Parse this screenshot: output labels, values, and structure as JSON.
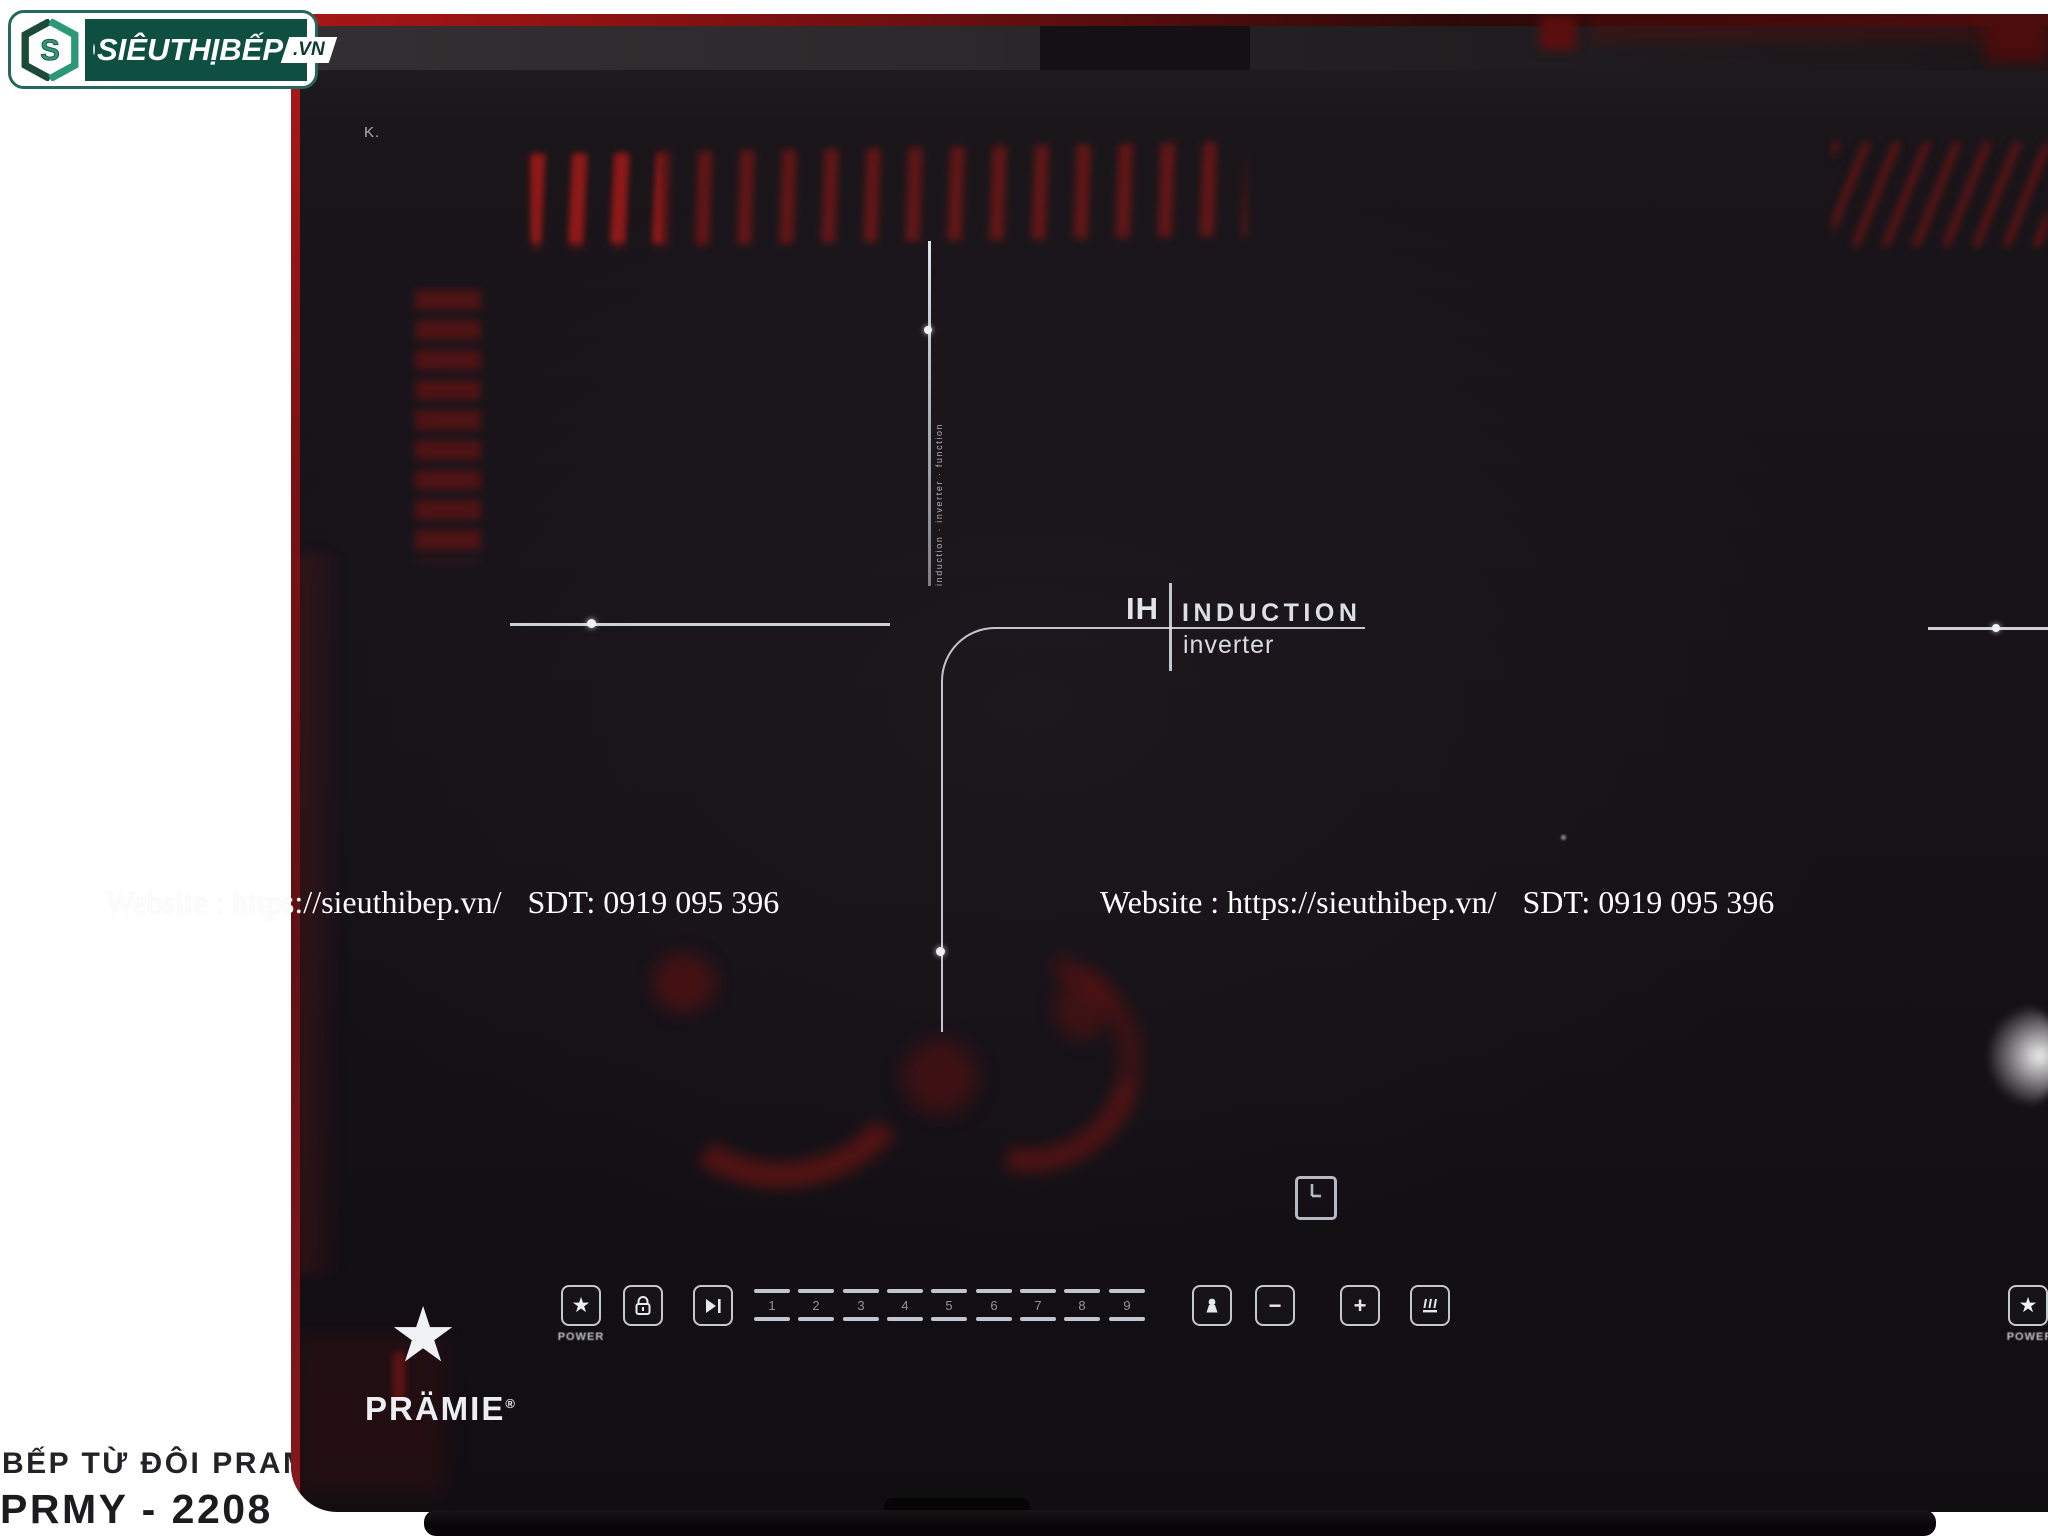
{
  "vendor_logo": {
    "monogram": "S",
    "text": "SIÊUTHỊBẾP",
    "tld": ".VN"
  },
  "watermark": {
    "site": "Website : https://sieuthibep.vn/",
    "phone": "SDT: 0919 095 396"
  },
  "surface": {
    "corner_mark": "K.",
    "micro_text": "induction · inverter · function"
  },
  "ih_badge": {
    "ih": "IH",
    "induction": "INDUCTION",
    "inverter": "inverter"
  },
  "brand": {
    "star": "★",
    "name": "PRÄMIE",
    "reg": "®"
  },
  "controls": {
    "power_label": "POWER",
    "digits": [
      "1",
      "2",
      "3",
      "4",
      "5",
      "6",
      "7",
      "8",
      "9"
    ],
    "icons": {
      "power": "★",
      "lock": "padlock",
      "timer_select": "play-pause",
      "booster": "pot",
      "minus": "−",
      "plus": "+",
      "grill": "grill-lines"
    }
  },
  "caption": {
    "line1": "BẾP TỪ ĐÔI PRAMIE",
    "line2": "PRMY - 2208"
  },
  "colors": {
    "accent_red": "#8e1313",
    "panel_line": "#d8dae1",
    "logo_green": "#0e4f41",
    "logo_border": "#26685c",
    "surface_black": "#151117"
  }
}
